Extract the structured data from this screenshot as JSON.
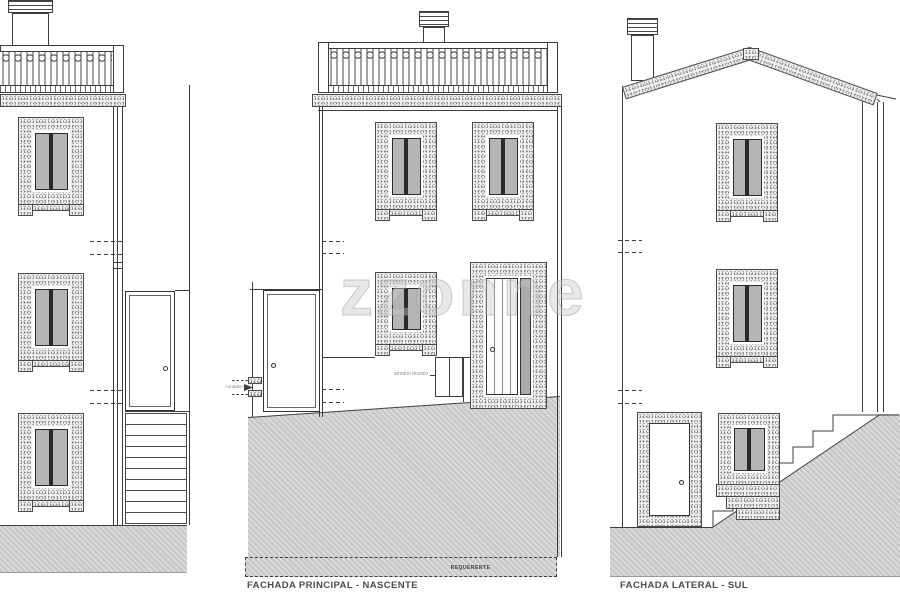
{
  "drawing": {
    "watermark_text": "zzonne",
    "captions": {
      "principal": "FACHADA PRINCIPAL - NASCENTE",
      "lateral": "FACHADA LATERAL - SUL"
    },
    "annotations": {
      "requerente_label": "REQUERENTE",
      "cabinet_label": "armário técnico",
      "meter_label": "contador"
    },
    "colors": {
      "line": "#3d3d3d",
      "pane_gray": "#b5b5b5",
      "stone_gray": "#efefef",
      "ground_gray": "#c9c9c9",
      "watermark_gray": "#c5c5c5"
    }
  }
}
